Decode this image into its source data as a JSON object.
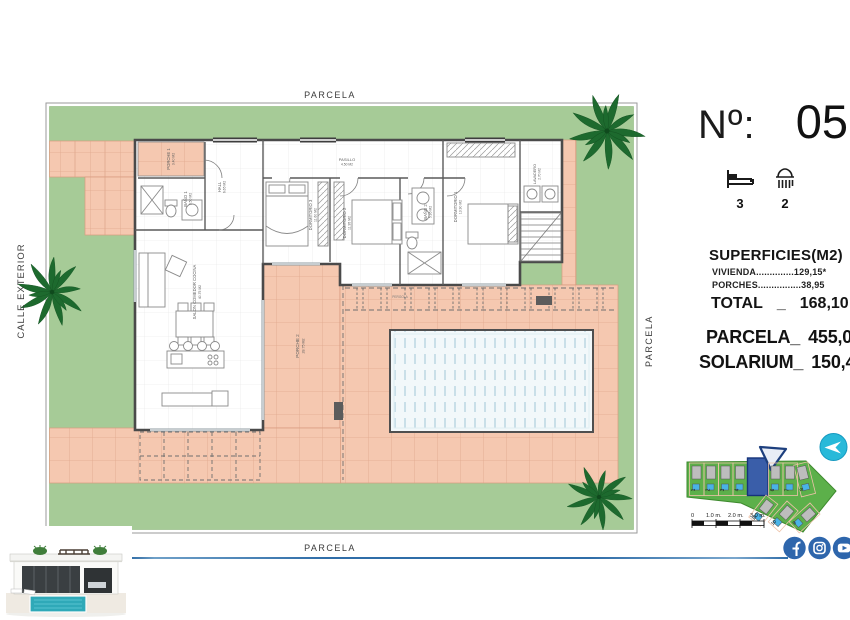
{
  "header": {
    "no_label": "Nº:",
    "number": "05"
  },
  "features": {
    "beds": "3",
    "showers": "2"
  },
  "surfaces": {
    "heading": "SUPERFICIES(M2)",
    "line1": "VIVIENDA..............129,15*",
    "line2": "PORCHES................38,95",
    "total_label": "TOTAL",
    "total_sep": "_",
    "total_value": "168,10",
    "parcela_label": "PARCELA_",
    "parcela_value": "455,00",
    "solarium_label": "SOLARIUM_",
    "solarium_value": "150,40"
  },
  "plan": {
    "parcela_top": "PARCELA",
    "parcela_bottom": "PARCELA",
    "parcela_right": "PARCELA",
    "calle_exterior": "CALLE EXTERIOR",
    "pergola_label": "PERGOLA",
    "rooms": [
      {
        "name": "PORCHE 1",
        "area": "3.40 M2"
      },
      {
        "name": "BAÑO 1",
        "area": "3.50 M2"
      },
      {
        "name": "HALL",
        "area": "6.65 M2"
      },
      {
        "name": "SALON COMEDOR COCINA",
        "area": "40.75 M2"
      },
      {
        "name": "DORMITORIO 3",
        "area": "11.60 M2"
      },
      {
        "name": "PASILLO",
        "area": "4.50 M2"
      },
      {
        "name": "DORMITORIO 2",
        "area": "11.95 M2"
      },
      {
        "name": "BAÑO 2",
        "area": "5.95 M2"
      },
      {
        "name": "DORMITORIO 1",
        "area": "13.90 M2"
      },
      {
        "name": "LAVADERO",
        "area": "2.70 M2"
      },
      {
        "name": "PORCHE 2",
        "area": "28.75 M2"
      }
    ]
  },
  "sitemap": {
    "plots_left": [
      "1",
      "2",
      "3",
      "4"
    ],
    "highlighted": "5",
    "plots_right": [
      "6",
      "7",
      "8"
    ],
    "plots_bottom": [
      "11",
      "10",
      "9"
    ],
    "scale": [
      "0",
      "1.0 m.",
      "2.0 m.",
      "3.0 m."
    ]
  },
  "icons": {
    "bed": "bed-icon",
    "shower": "shower-icon",
    "facebook": "facebook-icon",
    "instagram": "instagram-icon",
    "youtube": "youtube-icon",
    "logo": "send-arrow-logo"
  },
  "colors": {
    "lawn": "#a6cb97",
    "paving": "#f5c8b0",
    "pool": "#f2f8fa",
    "sitemap_green": "#5cb04a",
    "highlight_blue": "#3a5ea9",
    "social_blue": "#2e66ac",
    "logo_teal": "#28b9d9",
    "line_blue": "#2f6da8"
  }
}
